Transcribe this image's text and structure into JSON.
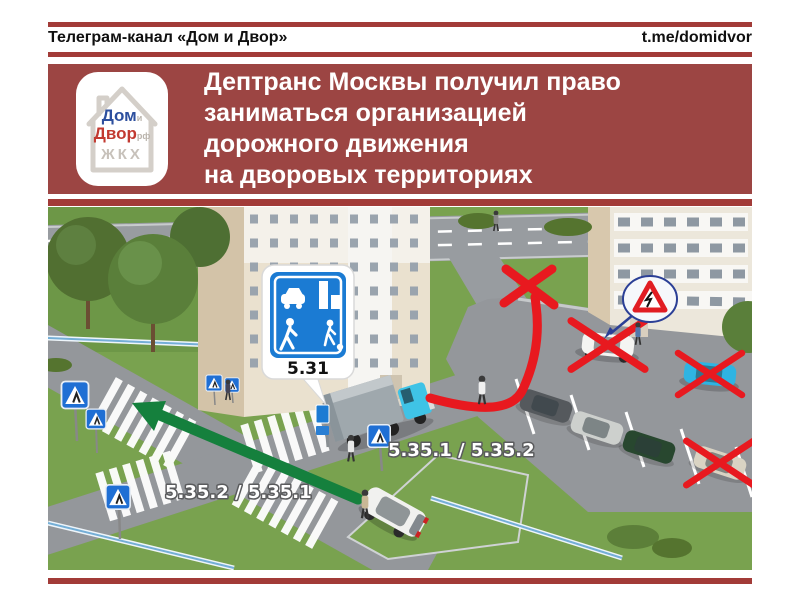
{
  "header": {
    "channel": "Телеграм-канал «Дом и Двор»",
    "url": "t.me/domidvor"
  },
  "banner": {
    "logo": {
      "word_top": "Дом",
      "word_top_suffix": "и",
      "word_bottom": "Двор",
      "word_bottom_suffix": "рф",
      "caption": "ЖКХ"
    },
    "title_lines": [
      "Дептранс Москвы получил право",
      "заниматься организацией",
      "дорожного движения",
      "на дворовых территориях"
    ]
  },
  "scene": {
    "residential_zone_sign_label": "5.31",
    "route_label_near_truck": "5.35.1 / 5.35.2",
    "route_label_intersection": "5.35.2 / 5.35.1"
  },
  "colors": {
    "accent_red": "#a23b38",
    "banner_red": "#9c4543",
    "route_arrow_red": "#e8191f",
    "route_arrow_green": "#15803d",
    "road_sign_blue": "#1b7bd3"
  }
}
